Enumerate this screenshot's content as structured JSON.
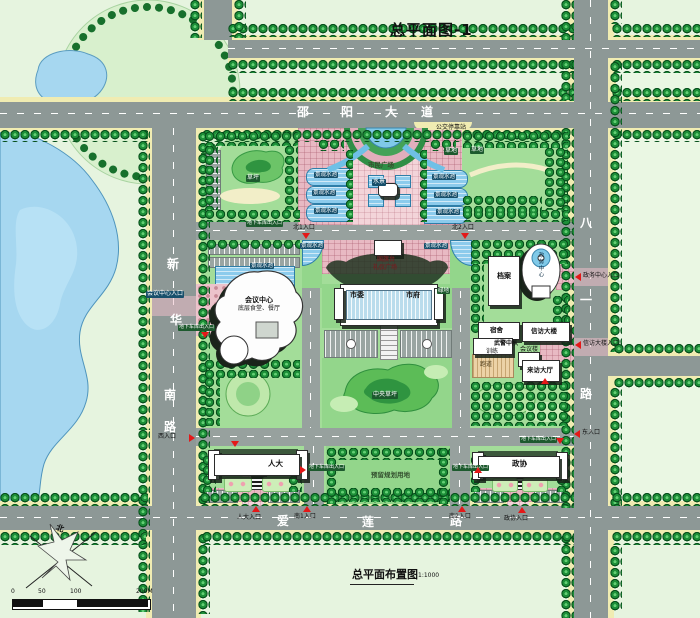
{
  "title": "总平面图-1",
  "caption": {
    "text": "总平面布置图",
    "scale": "1:1000"
  },
  "roads": {
    "shaoyang": [
      "邵",
      "阳",
      "大",
      "道"
    ],
    "xinhua": [
      "新",
      "华",
      "南",
      "路"
    ],
    "bayi": [
      "八",
      "一",
      "路"
    ],
    "ailian": [
      "爱",
      "莲",
      "路"
    ],
    "bus_stop": "公交停靠站"
  },
  "entrances": {
    "north1": "北1入口",
    "north2": "北2入口",
    "south1": "南1入口",
    "south2": "南2入口",
    "west": "西入口",
    "east": "东入口",
    "npc": "人大入口",
    "cppcc": "政协入口",
    "conference": "会议中心入口",
    "service": "政务中心入口",
    "petition": "信访大楼入口",
    "garage": "地下车库出入口"
  },
  "buildings": {
    "committee": "市委",
    "government": "市府",
    "conference": "会议中心",
    "canteen": "底层食堂、餐厅",
    "archives": "档案",
    "service_center": "政务中心",
    "dormitory": "宿舍",
    "petition": "信访大楼",
    "police": "武警中队",
    "training": "训练",
    "track": "跑道",
    "meeting": "会议楼",
    "visitor_hall": "来访大厅",
    "npc": "人大",
    "cppcc": "政协"
  },
  "features": {
    "plaza": "市民广场",
    "water": "水景",
    "lawn": "草坪",
    "grass": "草地",
    "pool": "景观水池",
    "flag": "国旗台",
    "ceremony": "礼仪广场",
    "green": "绿地",
    "central_lawn": "中央草坪",
    "reserved": "预留规划用地"
  },
  "legend": {
    "north": "北",
    "ticks": [
      "0",
      "50",
      "100",
      "200M"
    ]
  },
  "colors": {
    "road": "#8d9896",
    "water": "#a6d7f0",
    "tree": "#1d8f38",
    "plaza_pink": "#e8b9c3",
    "building": "#ffffff",
    "accent_red": "#e41818"
  }
}
